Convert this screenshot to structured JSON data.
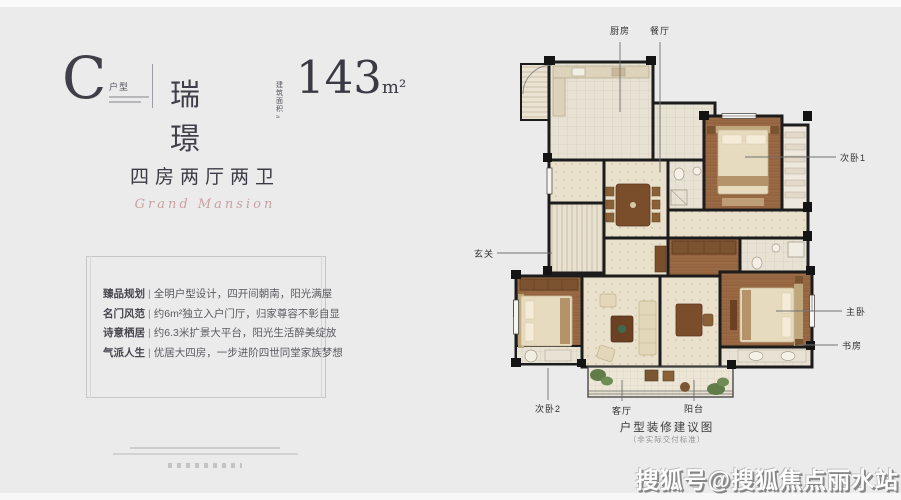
{
  "header": {
    "unit_letter": "C",
    "unit_type_label": "户型",
    "name": "瑞璟",
    "area_prefix_line1": "建筑",
    "area_prefix_line2": "面积≈",
    "area_value": "143",
    "area_unit": "m²"
  },
  "subtitle": {
    "cn": "四房两厅两卫",
    "en": "Grand Mansion"
  },
  "features": [
    {
      "label": "臻品规划",
      "sep": "|",
      "text": "全明户型设计，四开间朝南，阳光满屋"
    },
    {
      "label": "名门风范",
      "sep": "|",
      "text": "约6m²独立入户门厅，归家尊容不彰自显"
    },
    {
      "label": "诗意栖居",
      "sep": "|",
      "text": "约6.3米扩景大平台，阳光生活醉美绽放"
    },
    {
      "label": "气派人生",
      "sep": "|",
      "text": "优居大四房，一步进阶四世同堂家族梦想"
    }
  ],
  "plan": {
    "labels": {
      "kitchen": "厨房",
      "dining": "餐厅",
      "bedroom1": "次卧1",
      "entry": "玄关",
      "master": "主卧",
      "study": "书房",
      "bedroom2": "次卧2",
      "living": "客厅",
      "balcony": "阳台"
    },
    "caption": "户型装修建议图",
    "caption_note": "（非实际交付标准）"
  },
  "watermark": "搜狐号@搜狐焦点丽水站",
  "colors": {
    "background": "#ecebeb",
    "text_dark": "#3b3b45",
    "accent_pink": "#c9a2a2",
    "wall": "#1c1c1c",
    "wood_floor": "#9a6a44",
    "tile_floor": "#e9e1cc",
    "bed_fabric": "#e7dbbf",
    "plant_green": "#5f7c49"
  }
}
